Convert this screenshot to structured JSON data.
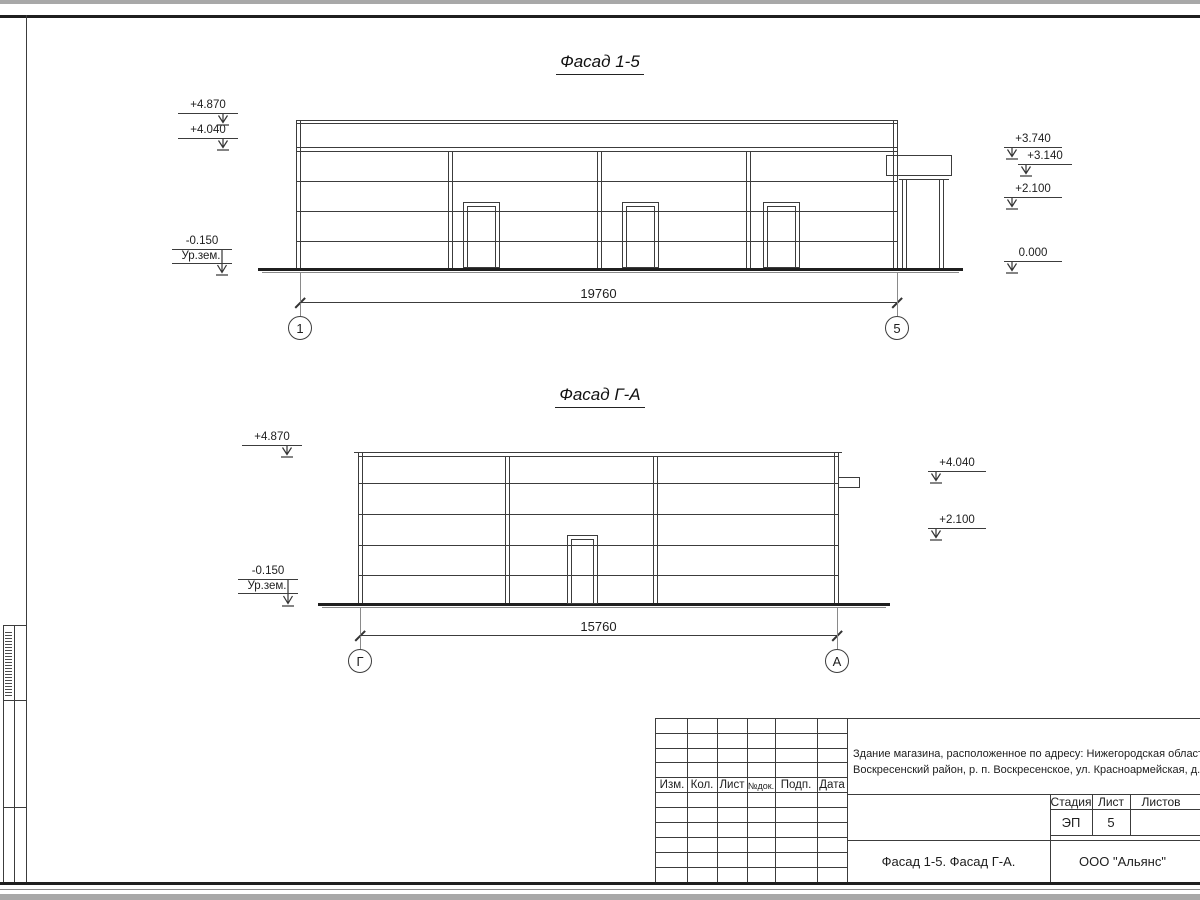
{
  "facade1": {
    "title": "Фасад 1-5",
    "dim": "19760",
    "axis_left": "1",
    "axis_right": "5",
    "marks_left": [
      "+4.870",
      "+4.040"
    ],
    "marks_right": [
      "+3.740",
      "+3.140",
      "+2.100",
      "0.000"
    ],
    "ground": {
      "level": "-0.150",
      "label": "Ур.зем."
    }
  },
  "facade2": {
    "title": "Фасад Г-А",
    "dim": "15760",
    "axis_left": "Г",
    "axis_right": "А",
    "marks_left": [
      "+4.870"
    ],
    "marks_right": [
      "+4.040",
      "+2.100"
    ],
    "ground": {
      "level": "-0.150",
      "label": "Ур.зем."
    }
  },
  "title_block": {
    "address_line1": "Здание магазина, расположенное по адресу: Нижегородская область,",
    "address_line2": "Воскресенский район, р. п. Воскресенское, ул. Красноармейская, д. 1",
    "rev_columns": [
      "Изм.",
      "Кол.",
      "Лист",
      "№док.",
      "Подп.",
      "Дата"
    ],
    "stage_label": "Стадия",
    "sheet_label": "Лист",
    "sheets_label": "Листов",
    "stage_value": "ЭП",
    "sheet_value": "5",
    "doc_title": "Фасад 1-5. Фасад Г-А.",
    "company": "ООО \"Альянс\""
  }
}
